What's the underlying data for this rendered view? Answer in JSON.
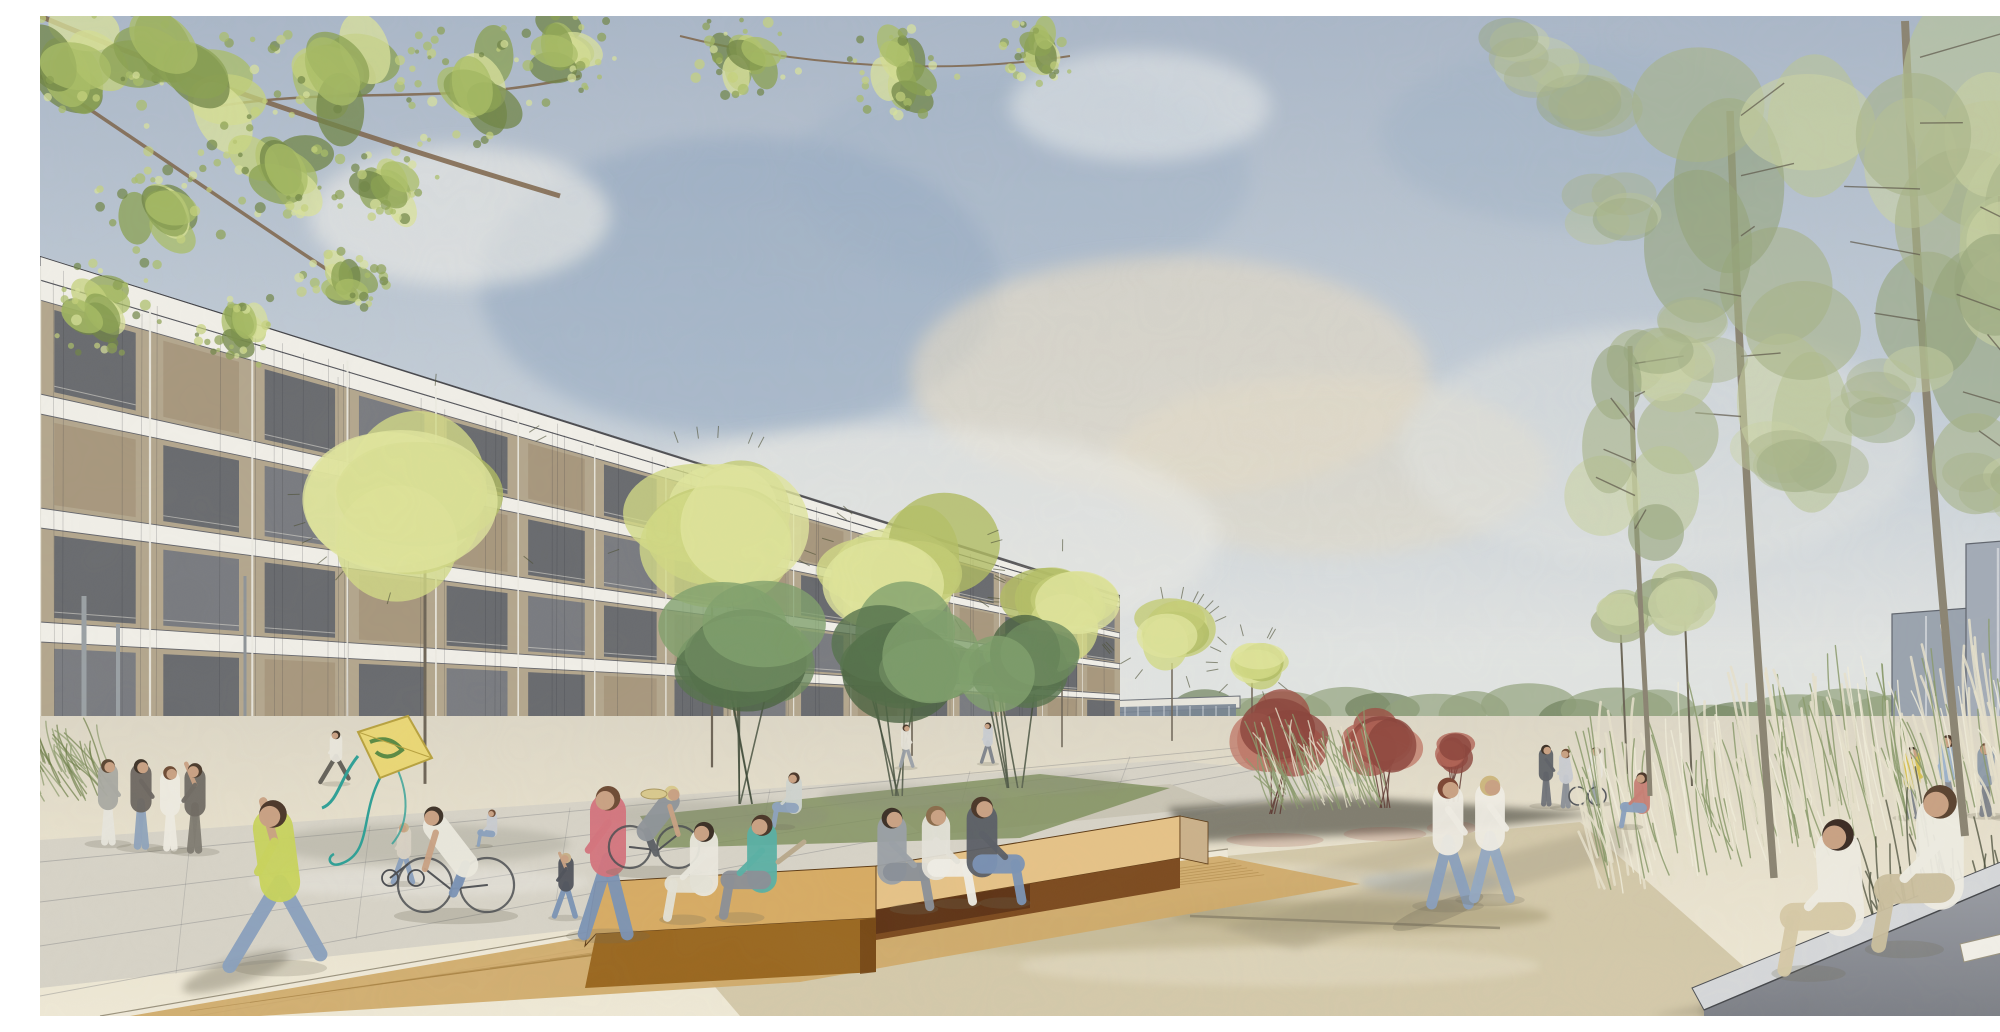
{
  "meta": {
    "title": "Watercolor architectural rendering of a residential plaza",
    "alt": "Watercolor-style architectural visualization: a long five-storey apartment building with a gridded facade recedes from the left toward a vanishing point; a row of round yellow-green trees stands in front of it. A wide sunlit plaza with pale paving and a shallow reflecting area fills the foreground, with wooden box benches where people sit, a girl running with a kite, cyclists and families strolling. To the right, tall sketchy trees, ornamental grasses, a grey concrete bench with a couple reading, red accent trees, a low grey wall and distant grey building volumes under a soft blue-grey cloudy sky."
  },
  "palette": {
    "sky_top": "#aab7c8",
    "sky_mid": "#c3cdd7",
    "sky_horizon": "#e7e7e3",
    "sky_deep": "#8ba2bd",
    "cloud_white": "#f0efe9",
    "cloud_warm": "#e7dcc6",
    "building_wall": "#b3a68d",
    "slab_white": "#f1efe8",
    "window_dark": "#5a5f69",
    "window_mid": "#6e737e",
    "infill_tan": "#a6967c",
    "ground_glass": "#87909d",
    "hedge": "#8b9c5f",
    "hedge_dark": "#6d7f49",
    "lawn": "#a6b166",
    "paving_cream": "#e9e2cf",
    "paving_grey": "#d7d3c7",
    "wet_paving": "#cfc3a2",
    "stone_border": "#efe9d8",
    "shadow": "#8f8872",
    "wood_top": "#d7ab63",
    "wood_light": "#e6c287",
    "wood_front": "#8a5a28",
    "wood_dark": "#5e3315",
    "deck": "#cfa968",
    "concrete_top": "#d6d8da",
    "concrete_front": "#85888e",
    "wall_grey": "#bcc1c8",
    "block_grey": "#9aa3ae",
    "glass_blue": "#778392",
    "grass_cream": "#e6e1cb",
    "grass_green": "#8a9a6b",
    "grass_dark": "#4a4d3a",
    "skin": "#c9a183",
    "street_tree_greens": [
      "#c3cc74",
      "#d2da86",
      "#e0e59c",
      "#b0bb62"
    ],
    "dark_tree_greens": [
      "#55724b",
      "#6b8a5c",
      "#7fa06c",
      "#4a6340"
    ],
    "red_tree_tones": [
      "#9d4f44",
      "#b06355",
      "#8a423a",
      "#c07a6a"
    ],
    "right_tree_sages": [
      "#a7b287",
      "#b9c496",
      "#c9d2a4",
      "#95a37a"
    ],
    "overhang_greens": [
      "#6f8444",
      "#8aa050",
      "#a9bd66",
      "#c4d27c",
      "#d9e29b"
    ]
  },
  "scene": {
    "street_trees": [
      {
        "x": 385,
        "cy": 475,
        "r": 132
      },
      {
        "x": 672,
        "cy": 505,
        "r": 104
      },
      {
        "x": 872,
        "cy": 545,
        "r": 86
      },
      {
        "x": 1022,
        "cy": 588,
        "r": 66
      },
      {
        "x": 1132,
        "cy": 622,
        "r": 50
      },
      {
        "x": 1212,
        "cy": 648,
        "r": 36
      }
    ],
    "dark_trees": [
      {
        "x": 705,
        "cy": 645,
        "r": 92,
        "base": 788
      },
      {
        "x": 860,
        "cy": 650,
        "r": 85,
        "base": 780
      },
      {
        "x": 975,
        "cy": 658,
        "r": 66,
        "base": 772
      }
    ],
    "red_trees": [
      {
        "x": 1235,
        "cy": 722,
        "r": 54,
        "base": 798
      },
      {
        "x": 1345,
        "cy": 726,
        "r": 46,
        "base": 792
      },
      {
        "x": 1412,
        "cy": 736,
        "r": 28,
        "base": 786
      }
    ],
    "right_trees": [
      {
        "cx": 1712,
        "cy": 250,
        "rx": 100,
        "ry": 215,
        "trunkTop": 95,
        "trunkBase": 862,
        "sway": -22
      },
      {
        "cx": 1895,
        "cy": 140,
        "rx": 115,
        "ry": 235,
        "trunkTop": 5,
        "trunkBase": 820,
        "sway": -30
      },
      {
        "cx": 1600,
        "cy": 430,
        "rx": 62,
        "ry": 118,
        "trunkTop": 330,
        "trunkBase": 780,
        "sway": -10
      },
      {
        "cx": 1975,
        "cy": 320,
        "rx": 75,
        "ry": 165,
        "trunkTop": 180,
        "trunkBase": 868,
        "sway": -14
      }
    ],
    "slender_trees": [
      {
        "x": 1588,
        "base": 776,
        "top": 600,
        "r": 40
      },
      {
        "x": 1652,
        "base": 770,
        "top": 580,
        "r": 46
      }
    ],
    "overhang_clusters": [
      {
        "x": 45,
        "y": 38,
        "r": 90
      },
      {
        "x": 160,
        "y": 62,
        "r": 98
      },
      {
        "x": 305,
        "y": 48,
        "r": 92
      },
      {
        "x": 432,
        "y": 72,
        "r": 76
      },
      {
        "x": 522,
        "y": 30,
        "r": 60
      },
      {
        "x": 242,
        "y": 152,
        "r": 72
      },
      {
        "x": 122,
        "y": 192,
        "r": 66
      },
      {
        "x": 62,
        "y": 292,
        "r": 56
      },
      {
        "x": 352,
        "y": 162,
        "r": 52
      },
      {
        "x": 202,
        "y": 312,
        "r": 46
      },
      {
        "x": 302,
        "y": 262,
        "r": 42
      },
      {
        "x": 705,
        "y": 40,
        "r": 52
      },
      {
        "x": 862,
        "y": 58,
        "r": 56
      },
      {
        "x": 1002,
        "y": 32,
        "r": 42
      }
    ],
    "people": [
      {
        "id": "standing-woman-grey",
        "type": "stand",
        "x": 68,
        "base": 826,
        "h": 84,
        "dir": 1,
        "shirt": "#a9a9a2",
        "pants": "#e8e6dd",
        "hair": "#5a4632"
      },
      {
        "id": "standing-man-dark",
        "type": "stand",
        "x": 101,
        "base": 830,
        "h": 88,
        "dir": 1,
        "shirt": "#6b655f",
        "pants": "#8fa3bb",
        "hair": "#3e3227"
      },
      {
        "id": "standing-woman-white-dress",
        "type": "stand",
        "x": 130,
        "base": 832,
        "h": 83,
        "dir": 1,
        "shirt": "#efece2",
        "pants": "#efece2",
        "hair": "#6d4a33"
      },
      {
        "id": "standing-man-reaching",
        "type": "stand",
        "x": 155,
        "base": 834,
        "h": 88,
        "dir": -1,
        "shirt": "#6f6a62",
        "pants": "#7e7a70",
        "hair": "#4a3a2c",
        "armUp": true
      },
      {
        "id": "girl-flying-kite",
        "type": "run",
        "x": 240,
        "base": 950,
        "h": 168,
        "dir": -1,
        "shirt": "#c9d45c",
        "pants": "#8aa0bd",
        "hair": "#4a3628",
        "lean": -7,
        "armUp": true
      },
      {
        "id": "jogger-distant",
        "type": "run",
        "x": 296,
        "base": 766,
        "h": 52,
        "dir": -1,
        "shirt": "#e9e6dc",
        "pants": "#5f5c55",
        "hair": "#3e3227"
      },
      {
        "id": "child-balance-bike",
        "type": "child",
        "x": 364,
        "base": 866,
        "h": 60,
        "dir": -1,
        "shirt": "#d9d2c4",
        "pants": "#8aa0bd",
        "hair": "#c7b089"
      },
      {
        "id": "cyclist-with-child-seat",
        "type": "bike",
        "x": 416,
        "base": 896,
        "h": 128,
        "dir": -1,
        "shirt": "#eceadf",
        "pants": "#7b93b5",
        "hair": "#3e3227",
        "wheel": 27
      },
      {
        "id": "child-in-bike-seat",
        "type": "sit",
        "x": 452,
        "seat": 816,
        "h": 44,
        "dir": -1,
        "shirt": "#c9ccd1",
        "pants": "#8aa0bd",
        "hair": "#6d4a33"
      },
      {
        "id": "toddler-walking",
        "type": "child",
        "x": 526,
        "base": 900,
        "h": 64,
        "dir": -1,
        "shirt": "#4f525a",
        "pants": "#7b93b5",
        "hair": "#c7b089",
        "armUp": true
      },
      {
        "id": "mother-pink-shirt",
        "type": "walk",
        "x": 568,
        "base": 918,
        "h": 150,
        "dir": -1,
        "shirt": "#d4737d",
        "pants": "#7b93b5",
        "hair": "#6d4a33"
      },
      {
        "id": "cyclist-straw-hat",
        "type": "bike",
        "x": 614,
        "base": 852,
        "h": 100,
        "dir": 1,
        "shirt": "#8f9499",
        "pants": "#5d6166",
        "hair": "#d9c98d",
        "wheel": 21
      },
      {
        "id": "woman-sitting-on-lawn",
        "type": "sit",
        "x": 754,
        "seat": 790,
        "h": 66,
        "dir": -1,
        "shirt": "#cfd4cf",
        "pants": "#8ea3bd",
        "hair": "#4a3628"
      },
      {
        "id": "pedestrian-distant-1",
        "type": "walk",
        "x": 866,
        "base": 750,
        "h": 42,
        "dir": 1,
        "shirt": "#e6e3d8",
        "pants": "#9aa0a8",
        "hair": "#4a3628"
      },
      {
        "id": "pedestrian-distant-2",
        "type": "walk",
        "x": 948,
        "base": 746,
        "h": 40,
        "dir": -1,
        "shirt": "#c9cdd2",
        "pants": "#7d828a",
        "hair": "#3e3227"
      },
      {
        "id": "bench-sitter-white",
        "type": "sit",
        "x": 664,
        "seat": 866,
        "h": 118,
        "dir": -1,
        "shirt": "#eae8de",
        "pants": "#e4e2d6",
        "hair": "#3a2e24"
      },
      {
        "id": "bench-sitter-teal",
        "type": "sit",
        "x": 722,
        "seat": 862,
        "h": 124,
        "dir": -1,
        "shirt": "#58b0a4",
        "pants": "#8b8f96",
        "hair": "#4a3628"
      },
      {
        "id": "bench-sitter-grey-dress",
        "type": "sit",
        "x": 852,
        "seat": 854,
        "h": 122,
        "dir": 1,
        "shirt": "#9aa0a6",
        "pants": "#8a9098",
        "hair": "#3a2e24"
      },
      {
        "id": "bench-sitter-white-pants",
        "type": "sit",
        "x": 896,
        "seat": 850,
        "h": 118,
        "dir": 1,
        "shirt": "#e5e3da",
        "pants": "#f0eee6",
        "hair": "#8a6b4a"
      },
      {
        "id": "bench-sitter-sunglasses",
        "type": "sit",
        "x": 942,
        "seat": 846,
        "h": 128,
        "dir": 1,
        "shirt": "#5a5e66",
        "pants": "#7b93b5",
        "hair": "#4a3628"
      },
      {
        "id": "walking-woman-auburn",
        "type": "walk",
        "x": 1408,
        "base": 888,
        "h": 128,
        "dir": 1,
        "shirt": "#efece3",
        "pants": "#8aa0bd",
        "hair": "#7c4634"
      },
      {
        "id": "walking-woman-blonde",
        "type": "walk",
        "x": 1450,
        "base": 882,
        "h": 124,
        "dir": 1,
        "shirt": "#f0ede4",
        "pants": "#93a8c2",
        "hair": "#cdb77f"
      },
      {
        "id": "distant-group-1",
        "type": "stand",
        "x": 1506,
        "base": 788,
        "h": 60,
        "dir": 1,
        "shirt": "#5f6268",
        "pants": "#6f7278",
        "hair": "#3e3227"
      },
      {
        "id": "distant-group-2",
        "type": "stand",
        "x": 1526,
        "base": 790,
        "h": 58,
        "dir": -1,
        "shirt": "#c9ccd1",
        "pants": "#8b9097",
        "hair": "#6d4a33"
      },
      {
        "id": "distant-group-3",
        "type": "stand",
        "x": 1556,
        "base": 786,
        "h": 56,
        "dir": -1,
        "shirt": "#e9e6dc",
        "pants": "#9aa0a8",
        "hair": "#4a3628"
      },
      {
        "id": "person-seated-on-wall",
        "type": "sit",
        "x": 1602,
        "seat": 790,
        "h": 66,
        "dir": -1,
        "shirt": "#c77f74",
        "pants": "#8aa0bd",
        "hair": "#4a3628"
      },
      {
        "id": "grass-figure-yellow",
        "type": "stand",
        "x": 1872,
        "base": 800,
        "h": 70,
        "dir": 1,
        "shirt": "#d8c14e",
        "pants": "#7d828a",
        "hair": "#3e3227"
      },
      {
        "id": "grass-figure-blue",
        "type": "stand",
        "x": 1908,
        "base": 796,
        "h": 78,
        "dir": -1,
        "shirt": "#9db3cc",
        "pants": "#8b9097",
        "hair": "#4a3628"
      },
      {
        "id": "grass-figure-grey",
        "type": "stand",
        "x": 1946,
        "base": 798,
        "h": 72,
        "dir": -1,
        "shirt": "#8d9aa8",
        "pants": "#7d828a",
        "hair": "#6d4a33"
      },
      {
        "id": "grass-figure-white",
        "type": "stand",
        "x": 1970,
        "base": 800,
        "h": 68,
        "dir": 1,
        "shirt": "#d4d7db",
        "pants": "#9aa0a8",
        "hair": "#3e3227"
      },
      {
        "id": "bench-woman-ice-cream",
        "type": "sit",
        "x": 1802,
        "seat": 898,
        "h": 186,
        "dir": -1,
        "shirt": "#efece2",
        "pants": "#d6c9a6",
        "hair": "#3a2a22",
        "lean": -4
      },
      {
        "id": "bench-man-reading",
        "type": "sit",
        "x": 1900,
        "seat": 870,
        "h": 198,
        "dir": -1,
        "shirt": "#efede3",
        "pants": "#cbbf9e",
        "hair": "#5a4330"
      }
    ],
    "kite": {
      "body": "#ead775",
      "swirl": "#3f7d3a",
      "ribbon": "#2fa096"
    }
  }
}
